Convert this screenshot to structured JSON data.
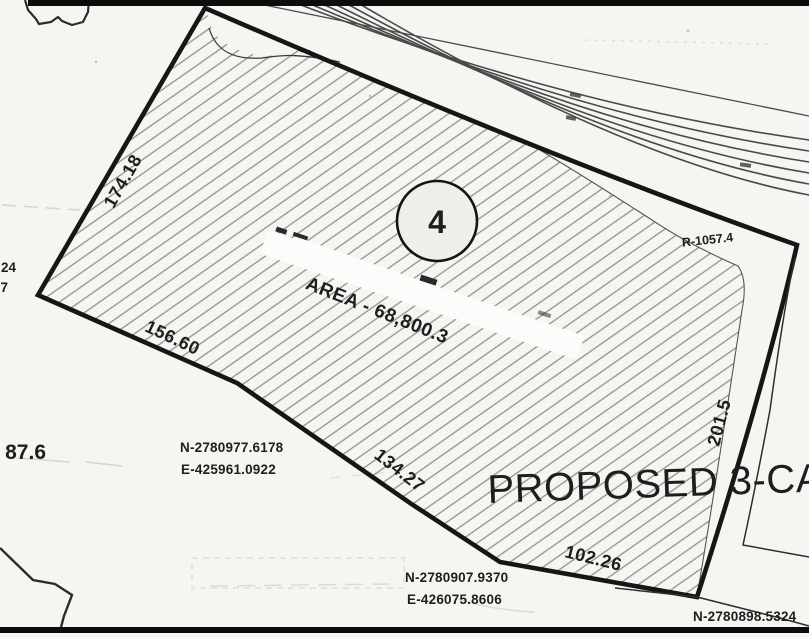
{
  "plat": {
    "lot": {
      "number": "4",
      "area_label": "AREA - 68,800.3"
    },
    "curve_radius_label": "R-1057.4",
    "proposed_label": "PROPOSED 3-CAB",
    "dimensions": {
      "northwest_edge": "174.18",
      "west_edge": "156.60",
      "southwest_edge": "134.27",
      "south_edge": "102.26",
      "southeast_edge": "201.5"
    },
    "coordinates": {
      "west_corner": {
        "northing": "N-2780977.6178",
        "easting": "E-425961.0922"
      },
      "south_corner": {
        "northing": "N-2780907.9370",
        "easting": "E-426075.8606"
      },
      "southeast_corner": {
        "northing": "N-2780898.5324"
      }
    },
    "clipped_left_edge_text": {
      "line1": "24",
      "line2": "7",
      "line3": "87.6"
    },
    "colors": {
      "paper": "#f6f5f2",
      "ink": "#1c1c1c",
      "hatch": "#8d8d8d"
    }
  }
}
